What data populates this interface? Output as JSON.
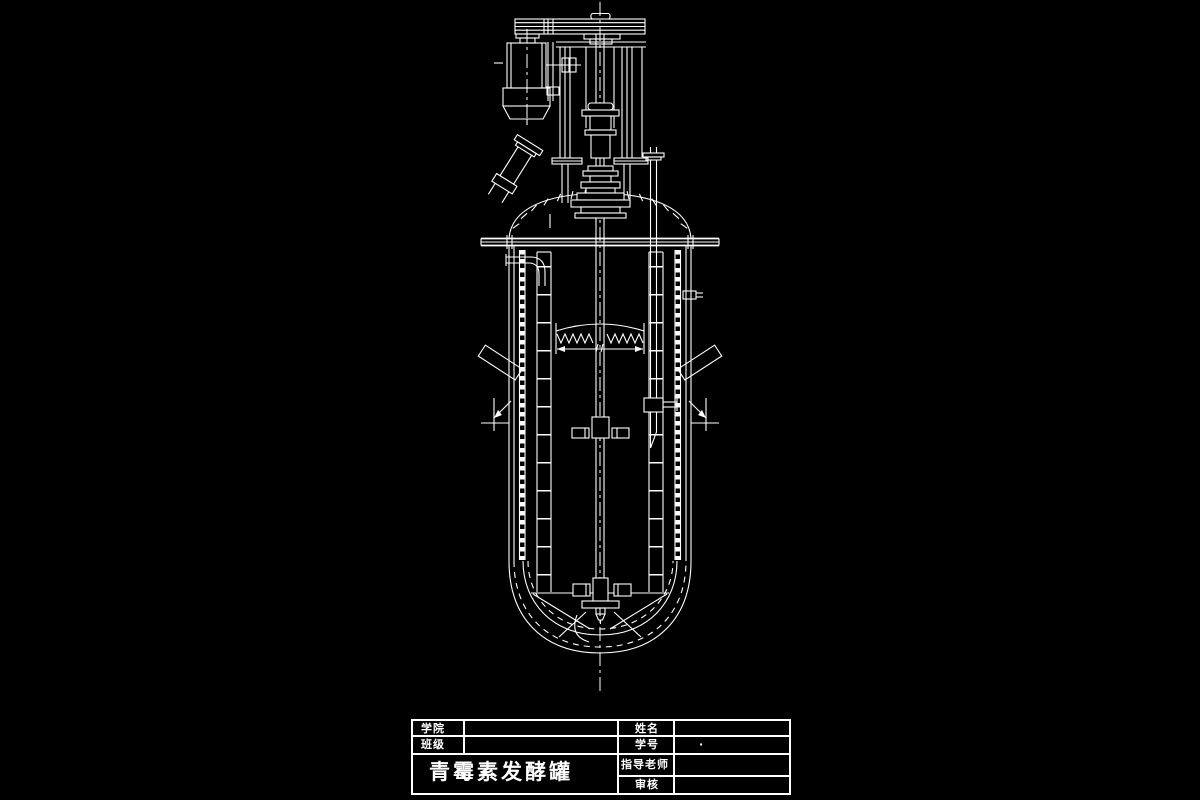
{
  "canvas": {
    "background": "#000000",
    "line_color": "#ffffff",
    "artifact_colors": {
      "cyan": "#35e0e0",
      "red": "#a00000",
      "green": "#00b050"
    }
  },
  "title_block": {
    "college_label": "学院",
    "class_label": "班级",
    "name_label": "姓名",
    "student_id_label": "学号",
    "student_id_value": "·",
    "advisor_label": "指导老师",
    "reviewer_label": "审核",
    "drawing_title": "青霉素发酵罐"
  }
}
